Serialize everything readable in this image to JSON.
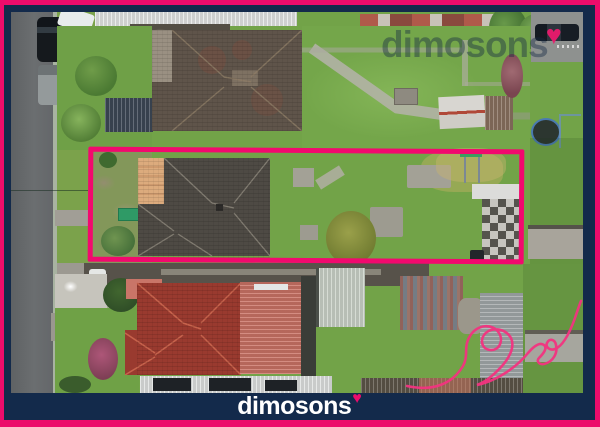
{
  "scene": {
    "kind": "real-estate aerial drone photo",
    "caption": "Top-down aerial view of a residential street; the listed lot (grey-roof house with long green backyard) is outlined in pink between two neighbouring houses."
  },
  "watermark": {
    "text": "dimosons",
    "heart": "♥"
  },
  "footer": {
    "brand": "dimosons",
    "heart": "♥"
  },
  "colors": {
    "brand_pink": "#EC0C6B",
    "brand_navy": "#132A4B",
    "outline_pink": "#F2096E",
    "watermark_tint": "rgba(21,40,66,0.42)"
  }
}
